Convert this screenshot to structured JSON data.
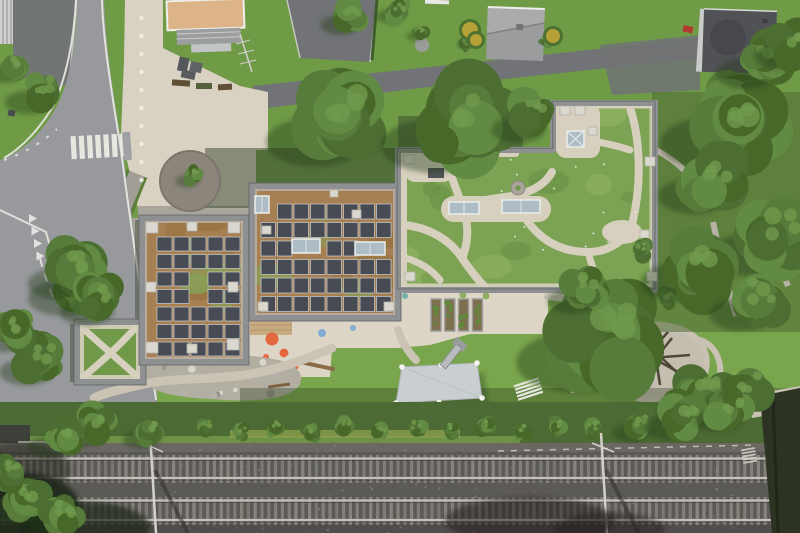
{
  "scene": {
    "type": "aerial-photograph",
    "description": "Top-down drone photo of a flat-roofed school building with two rooftop solar arrays and an extensive green roof crossed by organic gravel paths; surrounded by a road with zebra crossing (west), neighbouring houses and lawns (north), a garden with shade sail, raised beds and playground (south), and a multi-track railway line (bottom edge).",
    "landmarks": [
      "zebra-crossing",
      "concrete-plaza",
      "tree-planter-circle",
      "solar-roof-west",
      "solar-roof-north",
      "green-roof-east",
      "green-roof-annex",
      "raised-beds",
      "shade-sail",
      "metal-slide",
      "climbing-playground",
      "natural-play-gravel",
      "hedge-row",
      "railway-tracks",
      "catenary-masts",
      "neighbour-houses"
    ]
  },
  "palette": {
    "lawn": "#6f9b47",
    "lawn_light": "#7ca74f",
    "road": "#97999c",
    "road_dark": "#85878a",
    "asphalt": "#717376",
    "asphalt_dark": "#66686b",
    "plaza": "#d9d2c2",
    "terrace": "#ddd6c6",
    "gravel_circle": "#8b857b",
    "gravel_strip": "#a9a59c",
    "grey_path": "#a29e96",
    "parapet": "#8e9092",
    "parapet_dark": "#64666a",
    "roof_gravel": "#bcb8ae",
    "sedum": "#a67f52",
    "sedum_green": "#87a055",
    "green_roof": "#7ca353",
    "green_roof_light": "#8fb363",
    "green_roof_dark": "#699247",
    "roof_path": "#d7d0bf",
    "panel": "#474c54",
    "panel_frame": "#ccd1d6",
    "skylight": "#aebdc5",
    "skylight_frame": "#ebedeb",
    "pad": "#dbd8d0",
    "pad_stroke": "#b3b0a8",
    "ballast": "#5c5a57",
    "ballast_top": "#6b6864",
    "ballast_low": "#504e4b",
    "sleeper": "#8b8780",
    "rail": "#c4c1bb",
    "rail_shadow": "#393834",
    "mast": "#d3d1cb",
    "hedge": "#4c6a33",
    "verge": "#6d9146",
    "flower_strip": "#8a9d4e",
    "tree1": "#4c6e33",
    "tree2": "#567b3a",
    "tree3": "#618a42",
    "tree4": "#476829",
    "tree_hi": "#6f9a4c",
    "tree_shadow": "#243a18",
    "shadow_band": "#36432c",
    "dark_shadow": "#243618",
    "sail": "#c9ced1",
    "blue_sail": "#a3bcc9",
    "wood": "#cbb795",
    "white_step": "#e8e6e0",
    "white_line": "#eceae4",
    "orange_dot": "#e4683e",
    "blue_dot": "#85acd0",
    "teal_dot": "#74b0a8",
    "green_dot": "#8fae62",
    "stone_a": "#d8d5cd",
    "stone_b": "#b5b2aa",
    "stone_c": "#97948c",
    "log": "#8a6b46",
    "tan_roof": "#dcb488",
    "pergola": "#9b9d9f",
    "grey_roof": "#9a9c9e",
    "grey_roof_hi": "#a9abad",
    "dark_roof": "#515256",
    "facade": "#cfcfcd",
    "red_car": "#b23b31",
    "pole_wood": "#4f4639",
    "veg_dense": "#4f6a35",
    "wall_dark": "#2c3323",
    "play_gravel": "#c4beb0",
    "bed_soil": "#7e6f4e",
    "bed_frame": "#9a9c9e"
  },
  "solar_blocks": [
    {
      "id": "west-array",
      "x": 157,
      "y": 237,
      "cols": 5,
      "rows": 7,
      "dx": 17,
      "dy": 17.5,
      "w": 15,
      "h": 14,
      "skip": [
        "2,2",
        "3,2"
      ]
    },
    {
      "id": "north-array",
      "x": 261,
      "y": 204,
      "cols": 8,
      "rows": 6,
      "dx": 16.5,
      "dy": 18.5,
      "w": 14.5,
      "h": 15,
      "skip": [
        "0,0",
        "2,2",
        "2,3",
        "2,6",
        "2,7"
      ]
    }
  ],
  "mottle_zones": [
    {
      "clip": "clipA",
      "x": 145,
      "y": 221,
      "w": 98,
      "h": 138,
      "n": 10,
      "seed": 11
    },
    {
      "clip": "clipB",
      "x": 255,
      "y": 189,
      "w": 140,
      "h": 126,
      "n": 10,
      "seed": 23
    }
  ],
  "green_mottle": {
    "x": 402,
    "y": 108,
    "w": 250,
    "h": 178,
    "n": 14,
    "seed": 37
  },
  "roof_pads": [
    {
      "x": 146,
      "y": 222,
      "w": 12,
      "h": 11
    },
    {
      "x": 228,
      "y": 222,
      "w": 12,
      "h": 11
    },
    {
      "x": 146,
      "y": 342,
      "w": 12,
      "h": 11
    },
    {
      "x": 227,
      "y": 339,
      "w": 12,
      "h": 11
    },
    {
      "x": 146,
      "y": 282,
      "w": 10,
      "h": 10
    },
    {
      "x": 187,
      "y": 222,
      "w": 10,
      "h": 9
    },
    {
      "x": 187,
      "y": 344,
      "w": 10,
      "h": 9
    },
    {
      "x": 228,
      "y": 282,
      "w": 10,
      "h": 10
    },
    {
      "x": 258,
      "y": 302,
      "w": 10,
      "h": 9
    },
    {
      "x": 384,
      "y": 302,
      "w": 10,
      "h": 9
    },
    {
      "x": 352,
      "y": 210,
      "w": 9,
      "h": 8
    },
    {
      "x": 262,
      "y": 226,
      "w": 9,
      "h": 8
    },
    {
      "x": 330,
      "y": 190,
      "w": 8,
      "h": 7
    },
    {
      "x": 404,
      "y": 155,
      "w": 10,
      "h": 9
    },
    {
      "x": 432,
      "y": 153,
      "w": 9,
      "h": 8
    },
    {
      "x": 645,
      "y": 157,
      "w": 10,
      "h": 9
    },
    {
      "x": 647,
      "y": 272,
      "w": 10,
      "h": 9
    },
    {
      "x": 405,
      "y": 272,
      "w": 10,
      "h": 9
    },
    {
      "x": 560,
      "y": 106,
      "w": 10,
      "h": 9
    },
    {
      "x": 575,
      "y": 106,
      "w": 10,
      "h": 9
    },
    {
      "x": 588,
      "y": 127,
      "w": 9,
      "h": 8
    },
    {
      "x": 640,
      "y": 230,
      "w": 9,
      "h": 8
    }
  ],
  "skylights": [
    {
      "x": 292,
      "y": 239,
      "w": 28,
      "h": 14
    },
    {
      "x": 355,
      "y": 242,
      "w": 30,
      "h": 13
    },
    {
      "x": 255,
      "y": 196,
      "w": 14,
      "h": 17
    },
    {
      "x": 449,
      "y": 202,
      "w": 30,
      "h": 12
    },
    {
      "x": 502,
      "y": 200,
      "w": 38,
      "h": 13
    },
    {
      "x": 567,
      "y": 131,
      "w": 17,
      "h": 16,
      "braced": true
    }
  ],
  "plaza_dots": {
    "x": 141.5,
    "y0": 18,
    "step": 18,
    "count": 10,
    "r": 2.2
  },
  "ground_dots": [
    {
      "x": 272,
      "y": 339,
      "r": 6.5,
      "c": "orange_dot"
    },
    {
      "x": 284,
      "y": 353,
      "r": 4.5,
      "c": "orange_dot"
    },
    {
      "x": 266,
      "y": 357,
      "r": 3,
      "c": "orange_dot"
    },
    {
      "x": 296,
      "y": 367,
      "r": 2.5,
      "c": "orange_dot"
    },
    {
      "x": 322,
      "y": 333,
      "r": 4,
      "c": "blue_dot"
    },
    {
      "x": 353,
      "y": 328,
      "r": 3,
      "c": "blue_dot"
    },
    {
      "x": 405,
      "y": 296,
      "r": 3,
      "c": "teal_dot"
    },
    {
      "x": 463,
      "y": 295,
      "r": 3.5,
      "c": "green_dot"
    },
    {
      "x": 486,
      "y": 296,
      "r": 3.5,
      "c": "green_dot"
    },
    {
      "x": 357,
      "y": 281,
      "r": 3,
      "c": "green_dot"
    }
  ],
  "zebra": {
    "x0": 71,
    "y": 135,
    "count": 7,
    "dx": 8.2,
    "w": 5.2,
    "h": 23
  },
  "yield_teeth": {
    "x0": 29,
    "y0": 214,
    "count": 4,
    "dx": 2.5,
    "dy": 12.5,
    "w": 8,
    "h": 9
  },
  "raised_beds": {
    "x0": 431,
    "y": 299,
    "count": 4,
    "dx": 13.8,
    "w": 10,
    "h": 32
  },
  "railway": {
    "top": 443,
    "tracks": [
      {
        "sleeper_y": 455
      },
      {
        "sleeper_y": 497
      }
    ],
    "sleeper": {
      "w": 3.2,
      "h": 28,
      "step": 6.8
    },
    "rail_offsets": [
      3.5,
      23
    ],
    "masts": [
      {
        "x": 150,
        "arm_dx": -11,
        "arm_dy": -14
      },
      {
        "x": 601,
        "arm_dx": -9,
        "arm_dy": -12
      }
    ]
  },
  "speckles": {
    "count": 460,
    "seed": 91
  },
  "stones": {
    "count": 18,
    "x": 155,
    "y": 358,
    "w": 140,
    "h": 38,
    "seed": 55
  },
  "flower_dots": {
    "count": 14,
    "x": 405,
    "y": 155,
    "w": 243,
    "h": 128,
    "seed": 77
  },
  "trees": [
    {
      "x": 340,
      "y": 120,
      "r": 55
    },
    {
      "x": 462,
      "y": 122,
      "r": 60
    },
    {
      "x": 532,
      "y": 118,
      "r": 30
    },
    {
      "x": 608,
      "y": 335,
      "r": 68
    },
    {
      "x": 585,
      "y": 290,
      "r": 28
    },
    {
      "x": 738,
      "y": 120,
      "r": 58
    },
    {
      "x": 775,
      "y": 235,
      "r": 48
    },
    {
      "x": 700,
      "y": 265,
      "r": 44
    },
    {
      "x": 762,
      "y": 60,
      "r": 34
    },
    {
      "x": 792,
      "y": 45,
      "r": 28
    },
    {
      "x": 712,
      "y": 180,
      "r": 40
    },
    {
      "x": 758,
      "y": 300,
      "r": 36
    },
    {
      "x": 705,
      "y": 395,
      "r": 35
    },
    {
      "x": 745,
      "y": 390,
      "r": 30
    },
    {
      "x": 82,
      "y": 282,
      "r": 40
    },
    {
      "x": 75,
      "y": 270,
      "r": 35
    },
    {
      "x": 100,
      "y": 300,
      "r": 30
    },
    {
      "x": 40,
      "y": 92,
      "r": 26
    },
    {
      "x": 14,
      "y": 66,
      "r": 20
    },
    {
      "x": 193,
      "y": 176,
      "r": 13
    },
    {
      "x": 40,
      "y": 360,
      "r": 30
    },
    {
      "x": 15,
      "y": 330,
      "r": 26
    },
    {
      "x": 95,
      "y": 425,
      "r": 26
    },
    {
      "x": 60,
      "y": 438,
      "r": 24
    },
    {
      "x": 150,
      "y": 432,
      "r": 20
    },
    {
      "x": 640,
      "y": 425,
      "r": 20
    },
    {
      "x": 685,
      "y": 415,
      "r": 30
    },
    {
      "x": 730,
      "y": 410,
      "r": 26
    },
    {
      "x": 25,
      "y": 500,
      "r": 30
    },
    {
      "x": 62,
      "y": 515,
      "r": 26
    },
    {
      "x": 10,
      "y": 472,
      "r": 20
    },
    {
      "x": 350,
      "y": 16,
      "r": 22
    },
    {
      "x": 398,
      "y": 10,
      "r": 16
    },
    {
      "x": 420,
      "y": 32,
      "r": 10
    }
  ],
  "bushes": [
    {
      "x": 205,
      "y": 428,
      "r": 14
    },
    {
      "x": 240,
      "y": 432,
      "r": 12
    },
    {
      "x": 275,
      "y": 428,
      "r": 13
    },
    {
      "x": 310,
      "y": 433,
      "r": 13
    },
    {
      "x": 345,
      "y": 427,
      "r": 12
    },
    {
      "x": 380,
      "y": 431,
      "r": 13
    },
    {
      "x": 415,
      "y": 428,
      "r": 14
    },
    {
      "x": 450,
      "y": 430,
      "r": 12
    },
    {
      "x": 485,
      "y": 427,
      "r": 13
    },
    {
      "x": 520,
      "y": 431,
      "r": 12
    },
    {
      "x": 555,
      "y": 427,
      "r": 13
    },
    {
      "x": 590,
      "y": 430,
      "r": 14
    },
    {
      "x": 465,
      "y": 45,
      "r": 10
    },
    {
      "x": 545,
      "y": 42,
      "r": 8
    },
    {
      "x": 666,
      "y": 300,
      "r": 16
    },
    {
      "x": 640,
      "y": 250,
      "r": 14
    }
  ],
  "yellow_bushes": [
    {
      "x": 470,
      "y": 30,
      "r": 8
    },
    {
      "x": 476,
      "y": 40,
      "r": 6
    },
    {
      "x": 553,
      "y": 36,
      "r": 7
    }
  ]
}
